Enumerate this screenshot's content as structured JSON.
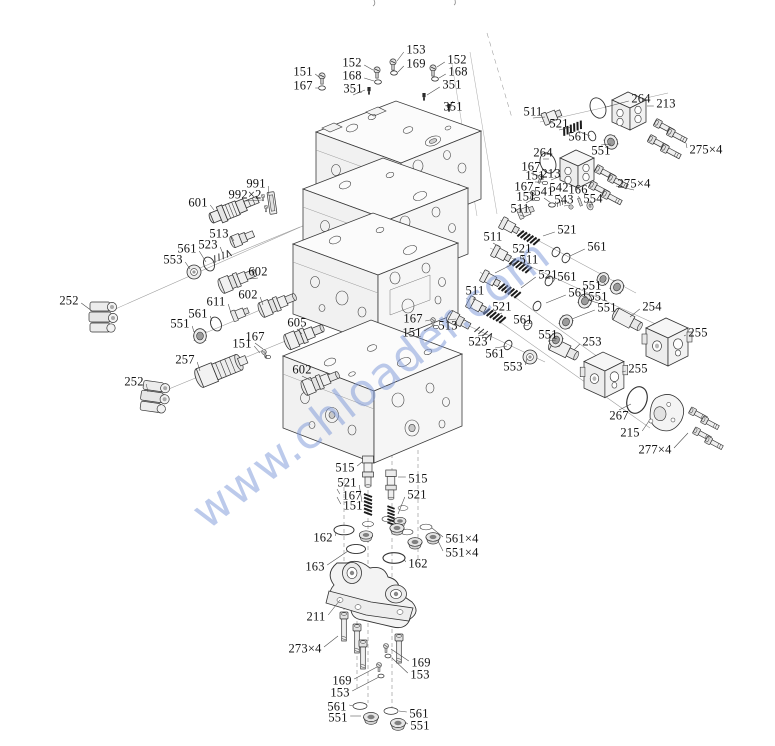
{
  "watermark": {
    "text": "www.chloader.com",
    "color": "#7b97d8"
  },
  "callouts": [
    {
      "t": "151",
      "x": 303,
      "y": 72,
      "lx": 319,
      "ly": 77
    },
    {
      "t": "167",
      "x": 303,
      "y": 86,
      "lx": 318,
      "ly": 88
    },
    {
      "t": "152",
      "x": 352,
      "y": 63,
      "lx": 373,
      "ly": 70
    },
    {
      "t": "168",
      "x": 352,
      "y": 76,
      "lx": 374,
      "ly": 81
    },
    {
      "t": "351",
      "x": 353,
      "y": 89,
      "lx": 365,
      "ly": 90
    },
    {
      "t": "153",
      "x": 416,
      "y": 50,
      "lx": 397,
      "ly": 61
    },
    {
      "t": "169",
      "x": 416,
      "y": 64,
      "lx": 398,
      "ly": 72
    },
    {
      "t": "152",
      "x": 457,
      "y": 60,
      "lx": 437,
      "ly": 67
    },
    {
      "t": "168",
      "x": 458,
      "y": 72,
      "lx": 439,
      "ly": 78
    },
    {
      "t": "351",
      "x": 452,
      "y": 85,
      "lx": 427,
      "ly": 95
    },
    {
      "t": "351",
      "x": 453,
      "y": 107,
      "lx": 450,
      "ly": 107
    },
    {
      "t": "511",
      "x": 533,
      "y": 112,
      "lx": 545,
      "ly": 117
    },
    {
      "t": "521",
      "x": 559,
      "y": 124,
      "lx": 571,
      "ly": 127
    },
    {
      "t": "561",
      "x": 578,
      "y": 137,
      "lx": 590,
      "ly": 136
    },
    {
      "t": "264",
      "x": 641,
      "y": 99,
      "lx": 606,
      "ly": 107
    },
    {
      "t": "213",
      "x": 666,
      "y": 104,
      "lx": 647,
      "ly": 106
    },
    {
      "t": "275×4",
      "x": 706,
      "y": 150,
      "lx": 686,
      "ly": 143
    },
    {
      "t": "264",
      "x": 543,
      "y": 153,
      "lx": 549,
      "ly": 159
    },
    {
      "t": "551",
      "x": 601,
      "y": 151,
      "lx": 611,
      "ly": 144
    },
    {
      "t": "167",
      "x": 531,
      "y": 167,
      "lx": 540,
      "ly": 176
    },
    {
      "t": "151",
      "x": 535,
      "y": 176,
      "lx": 543,
      "ly": 182
    },
    {
      "t": "213",
      "x": 551,
      "y": 174,
      "lx": 561,
      "ly": 176
    },
    {
      "t": "167",
      "x": 524,
      "y": 187,
      "lx": 532,
      "ly": 192
    },
    {
      "t": "151",
      "x": 526,
      "y": 197,
      "lx": 535,
      "ly": 198
    },
    {
      "t": "541",
      "x": 544,
      "y": 192,
      "lx": 551,
      "ly": 203
    },
    {
      "t": "542",
      "x": 559,
      "y": 188,
      "lx": 562,
      "ly": 199
    },
    {
      "t": "166",
      "x": 578,
      "y": 190,
      "lx": 580,
      "ly": 199
    },
    {
      "t": "543",
      "x": 564,
      "y": 200,
      "lx": 570,
      "ly": 205
    },
    {
      "t": "554",
      "x": 593,
      "y": 199,
      "lx": 589,
      "ly": 204
    },
    {
      "t": "275×4",
      "x": 634,
      "y": 184,
      "lx": 616,
      "ly": 186
    },
    {
      "t": "511",
      "x": 520,
      "y": 209,
      "lx": 523,
      "ly": 216
    },
    {
      "t": "521",
      "x": 567,
      "y": 230,
      "lx": 543,
      "ly": 236
    },
    {
      "t": "511",
      "x": 493,
      "y": 237,
      "lx": 500,
      "ly": 247
    },
    {
      "t": "521",
      "x": 522,
      "y": 249,
      "lx": 525,
      "ly": 261
    },
    {
      "t": "561",
      "x": 597,
      "y": 247,
      "lx": 570,
      "ly": 256
    },
    {
      "t": "511",
      "x": 529,
      "y": 260,
      "lx": 495,
      "ly": 273
    },
    {
      "t": "521",
      "x": 548,
      "y": 275,
      "lx": 521,
      "ly": 288
    },
    {
      "t": "561",
      "x": 567,
      "y": 277,
      "lx": 553,
      "ly": 282
    },
    {
      "t": "551",
      "x": 592,
      "y": 286,
      "lx": 605,
      "ly": 283
    },
    {
      "t": "561",
      "x": 578,
      "y": 293,
      "lx": 546,
      "ly": 303
    },
    {
      "t": "551",
      "x": 598,
      "y": 297,
      "lx": 588,
      "ly": 300
    },
    {
      "t": "511",
      "x": 475,
      "y": 291,
      "lx": 473,
      "ly": 300
    },
    {
      "t": "521",
      "x": 502,
      "y": 307,
      "lx": 499,
      "ly": 314
    },
    {
      "t": "551",
      "x": 607,
      "y": 308,
      "lx": 572,
      "ly": 319
    },
    {
      "t": "254",
      "x": 652,
      "y": 307,
      "lx": 630,
      "ly": 317
    },
    {
      "t": "561",
      "x": 523,
      "y": 320,
      "lx": 529,
      "ly": 325
    },
    {
      "t": "255",
      "x": 698,
      "y": 333,
      "lx": 684,
      "ly": 336
    },
    {
      "t": "551",
      "x": 548,
      "y": 335,
      "lx": 556,
      "ly": 340
    },
    {
      "t": "253",
      "x": 592,
      "y": 342,
      "lx": 574,
      "ly": 350
    },
    {
      "t": "513",
      "x": 448,
      "y": 326,
      "lx": 456,
      "ly": 319
    },
    {
      "t": "523",
      "x": 478,
      "y": 342,
      "lx": 487,
      "ly": 334
    },
    {
      "t": "561",
      "x": 495,
      "y": 354,
      "lx": 507,
      "ly": 346
    },
    {
      "t": "553",
      "x": 513,
      "y": 367,
      "lx": 527,
      "ly": 358
    },
    {
      "t": "167",
      "x": 413,
      "y": 319,
      "lx": 430,
      "ly": 320
    },
    {
      "t": "151",
      "x": 412,
      "y": 333,
      "lx": 432,
      "ly": 326
    },
    {
      "t": "255",
      "x": 638,
      "y": 369,
      "lx": 622,
      "ly": 372
    },
    {
      "t": "267",
      "x": 619,
      "y": 416,
      "lx": 631,
      "ly": 404
    },
    {
      "t": "215",
      "x": 630,
      "y": 433,
      "lx": 649,
      "ly": 421
    },
    {
      "t": "277×4",
      "x": 655,
      "y": 450,
      "lx": 688,
      "ly": 433
    },
    {
      "t": "991",
      "x": 256,
      "y": 184,
      "lx": 269,
      "ly": 196
    },
    {
      "t": "992×2",
      "x": 245,
      "y": 195,
      "lx": 262,
      "ly": 200
    },
    {
      "t": "601",
      "x": 198,
      "y": 203,
      "lx": 214,
      "ly": 210
    },
    {
      "t": "513",
      "x": 219,
      "y": 234,
      "lx": 234,
      "ly": 241
    },
    {
      "t": "523",
      "x": 208,
      "y": 245,
      "lx": 223,
      "ly": 254
    },
    {
      "t": "561",
      "x": 187,
      "y": 249,
      "lx": 206,
      "ly": 262
    },
    {
      "t": "553",
      "x": 173,
      "y": 260,
      "lx": 190,
      "ly": 269
    },
    {
      "t": "602",
      "x": 258,
      "y": 272,
      "lx": 249,
      "ly": 279
    },
    {
      "t": "602",
      "x": 248,
      "y": 295,
      "lx": 263,
      "ly": 305
    },
    {
      "t": "611",
      "x": 216,
      "y": 302,
      "lx": 231,
      "ly": 313
    },
    {
      "t": "561",
      "x": 198,
      "y": 314,
      "lx": 212,
      "ly": 321
    },
    {
      "t": "551",
      "x": 180,
      "y": 324,
      "lx": 194,
      "ly": 332
    },
    {
      "t": "605",
      "x": 297,
      "y": 323,
      "lx": 302,
      "ly": 334
    },
    {
      "t": "252",
      "x": 69,
      "y": 301,
      "lx": 92,
      "ly": 311
    },
    {
      "t": "167",
      "x": 255,
      "y": 337,
      "lx": 263,
      "ly": 349
    },
    {
      "t": "151",
      "x": 242,
      "y": 344,
      "lx": 260,
      "ly": 353
    },
    {
      "t": "257",
      "x": 185,
      "y": 360,
      "lx": 200,
      "ly": 371
    },
    {
      "t": "252",
      "x": 134,
      "y": 382,
      "lx": 148,
      "ly": 392
    },
    {
      "t": "602",
      "x": 302,
      "y": 370,
      "lx": 312,
      "ly": 381
    },
    {
      "t": "515",
      "x": 345,
      "y": 468,
      "lx": 362,
      "ly": 462
    },
    {
      "t": "521",
      "x": 347,
      "y": 483,
      "lx": 362,
      "ly": 502
    },
    {
      "t": "167",
      "x": 352,
      "y": 496,
      "lx": 337,
      "ly": 489
    },
    {
      "t": "151",
      "x": 353,
      "y": 506,
      "lx": 337,
      "ly": 497
    },
    {
      "t": "515",
      "x": 418,
      "y": 479,
      "lx": 398,
      "ly": 477
    },
    {
      "t": "521",
      "x": 417,
      "y": 495,
      "lx": 398,
      "ly": 514
    },
    {
      "t": "162",
      "x": 323,
      "y": 538,
      "lx": 336,
      "ly": 532
    },
    {
      "t": "561×4",
      "x": 462,
      "y": 539,
      "lx": 432,
      "ly": 528
    },
    {
      "t": "551×4",
      "x": 462,
      "y": 553,
      "lx": 438,
      "ly": 541
    },
    {
      "t": "163",
      "x": 315,
      "y": 567,
      "lx": 348,
      "ly": 551
    },
    {
      "t": "162",
      "x": 418,
      "y": 564,
      "lx": 404,
      "ly": 559
    },
    {
      "t": "211",
      "x": 316,
      "y": 617,
      "lx": 340,
      "ly": 600
    },
    {
      "t": "273×4",
      "x": 305,
      "y": 649,
      "lx": 338,
      "ly": 636
    },
    {
      "t": "169",
      "x": 421,
      "y": 663,
      "lx": 391,
      "ly": 649
    },
    {
      "t": "153",
      "x": 420,
      "y": 675,
      "lx": 392,
      "ly": 658
    },
    {
      "t": "169",
      "x": 342,
      "y": 681,
      "lx": 377,
      "ly": 667
    },
    {
      "t": "153",
      "x": 340,
      "y": 693,
      "lx": 379,
      "ly": 677
    },
    {
      "t": "561",
      "x": 337,
      "y": 707,
      "lx": 353,
      "ly": 706
    },
    {
      "t": "551",
      "x": 338,
      "y": 718,
      "lx": 361,
      "ly": 716
    },
    {
      "t": "561",
      "x": 419,
      "y": 714,
      "lx": 399,
      "ly": 711
    },
    {
      "t": "551",
      "x": 420,
      "y": 726,
      "lx": 405,
      "ly": 722
    }
  ]
}
